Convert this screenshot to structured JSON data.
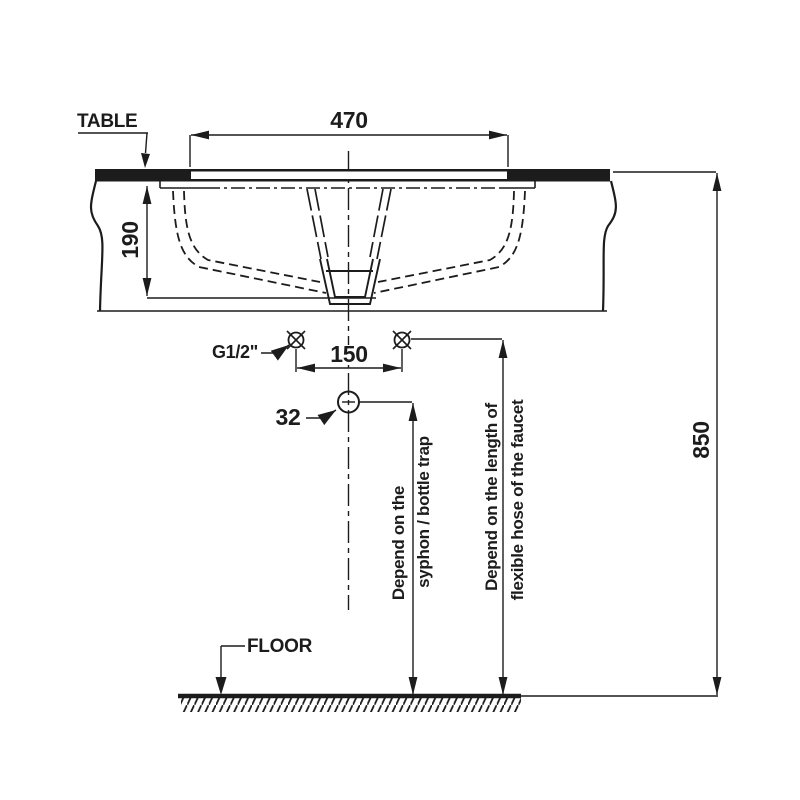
{
  "drawing": {
    "labels": {
      "table": "TABLE",
      "floor": "FLOOR",
      "supply_thread": "G1/2\"",
      "drain_diameter": "32"
    },
    "dimensions": {
      "basin_opening_width": "470",
      "basin_depth": "190",
      "faucet_hole_spacing": "150",
      "rim_height_from_floor": "850"
    },
    "notes": {
      "syphon": {
        "line1": "Depend on the",
        "line2": "syphon / bottle trap"
      },
      "hose": {
        "line1": "Depend on the length of",
        "line2": "flexible hose of the faucet"
      }
    },
    "colors": {
      "line": "#1c1c1c",
      "background": "#ffffff"
    }
  }
}
